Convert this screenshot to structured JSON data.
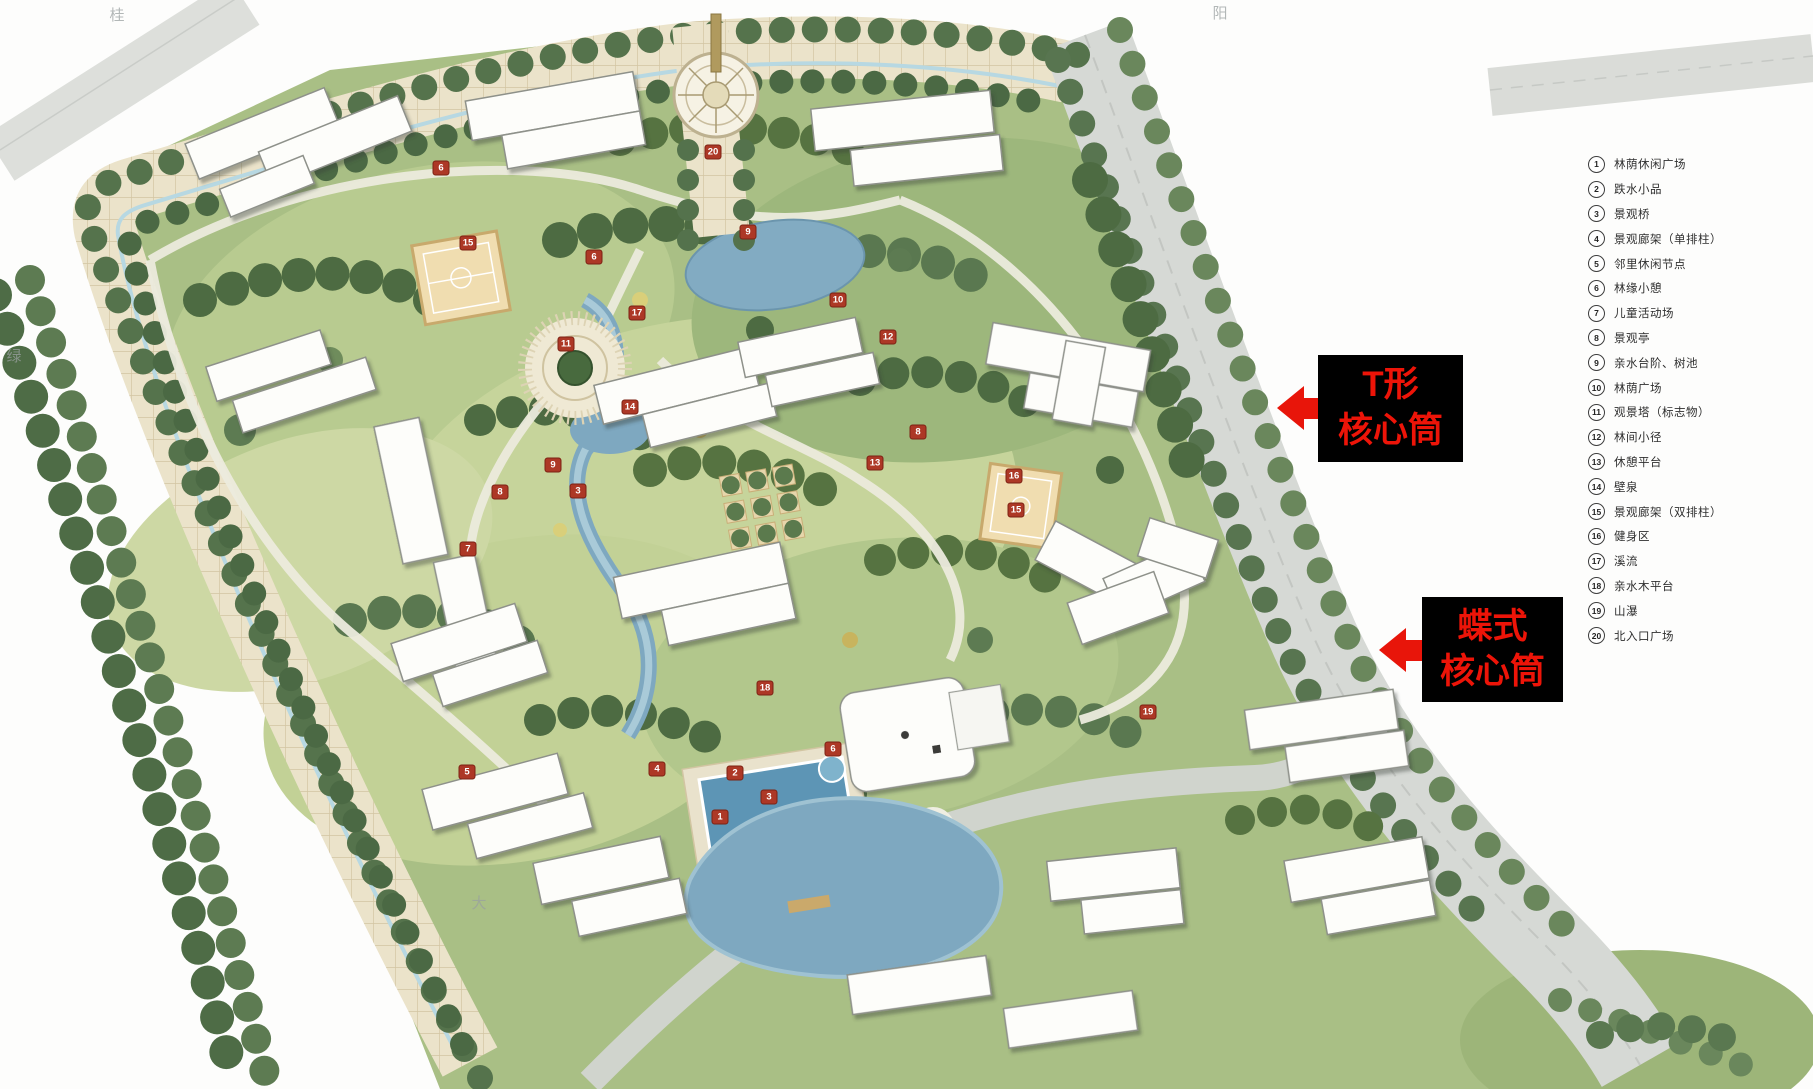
{
  "callouts": {
    "t_core": {
      "line1": "T形",
      "line2": "核心筒"
    },
    "butterfly_core": {
      "line1": "蝶式",
      "line2": "核心筒"
    }
  },
  "legend": {
    "items": [
      {
        "num": "1",
        "label": "林荫休闲广场"
      },
      {
        "num": "2",
        "label": "跌水小品"
      },
      {
        "num": "3",
        "label": "景观桥"
      },
      {
        "num": "4",
        "label": "景观廊架（单排柱）"
      },
      {
        "num": "5",
        "label": "邻里休闲节点"
      },
      {
        "num": "6",
        "label": "林缘小憩"
      },
      {
        "num": "7",
        "label": "儿童活动场"
      },
      {
        "num": "8",
        "label": "景观亭"
      },
      {
        "num": "9",
        "label": "亲水台阶、树池"
      },
      {
        "num": "10",
        "label": "林荫广场"
      },
      {
        "num": "11",
        "label": "观景塔（标志物）"
      },
      {
        "num": "12",
        "label": "林间小径"
      },
      {
        "num": "13",
        "label": "休憩平台"
      },
      {
        "num": "14",
        "label": "壁泉"
      },
      {
        "num": "15",
        "label": "景观廊架（双排柱）"
      },
      {
        "num": "16",
        "label": "健身区"
      },
      {
        "num": "17",
        "label": "溪流"
      },
      {
        "num": "18",
        "label": "亲水木平台"
      },
      {
        "num": "19",
        "label": "山瀑"
      },
      {
        "num": "20",
        "label": "北入口广场"
      }
    ]
  },
  "plan_markers": [
    {
      "num": "6",
      "x": 441,
      "y": 168
    },
    {
      "num": "15",
      "x": 468,
      "y": 243
    },
    {
      "num": "9",
      "x": 748,
      "y": 232
    },
    {
      "num": "6",
      "x": 594,
      "y": 257
    },
    {
      "num": "11",
      "x": 566,
      "y": 344
    },
    {
      "num": "17",
      "x": 637,
      "y": 313
    },
    {
      "num": "14",
      "x": 630,
      "y": 407
    },
    {
      "num": "10",
      "x": 838,
      "y": 300
    },
    {
      "num": "12",
      "x": 888,
      "y": 337
    },
    {
      "num": "8",
      "x": 918,
      "y": 432
    },
    {
      "num": "13",
      "x": 875,
      "y": 463
    },
    {
      "num": "16",
      "x": 1014,
      "y": 476
    },
    {
      "num": "15",
      "x": 1016,
      "y": 510
    },
    {
      "num": "9",
      "x": 553,
      "y": 465
    },
    {
      "num": "8",
      "x": 500,
      "y": 492
    },
    {
      "num": "3",
      "x": 578,
      "y": 491
    },
    {
      "num": "7",
      "x": 468,
      "y": 549
    },
    {
      "num": "5",
      "x": 467,
      "y": 772
    },
    {
      "num": "4",
      "x": 657,
      "y": 769
    },
    {
      "num": "2",
      "x": 735,
      "y": 773
    },
    {
      "num": "3",
      "x": 769,
      "y": 797
    },
    {
      "num": "1",
      "x": 720,
      "y": 817
    },
    {
      "num": "6",
      "x": 833,
      "y": 749
    },
    {
      "num": "18",
      "x": 765,
      "y": 688
    },
    {
      "num": "19",
      "x": 1148,
      "y": 712
    },
    {
      "num": "20",
      "x": 713,
      "y": 152
    }
  ],
  "edge_labels": [
    {
      "text": "桂",
      "x": 117,
      "y": 4
    },
    {
      "text": "阳",
      "x": 1220,
      "y": 2
    },
    {
      "text": "绿",
      "x": 14,
      "y": 345
    },
    {
      "text": "大",
      "x": 479,
      "y": 892
    }
  ],
  "colors": {
    "callout_bg": "#000000",
    "callout_text": "#ed1408",
    "arrow_red": "#e8150a",
    "marker_red": "#ad3826",
    "boulevard_cream": "#ebe3ca",
    "water_blue": "#7ea8c0",
    "lawn_green": "#a9bf85",
    "tree_dark_green": "#4d6b42"
  }
}
